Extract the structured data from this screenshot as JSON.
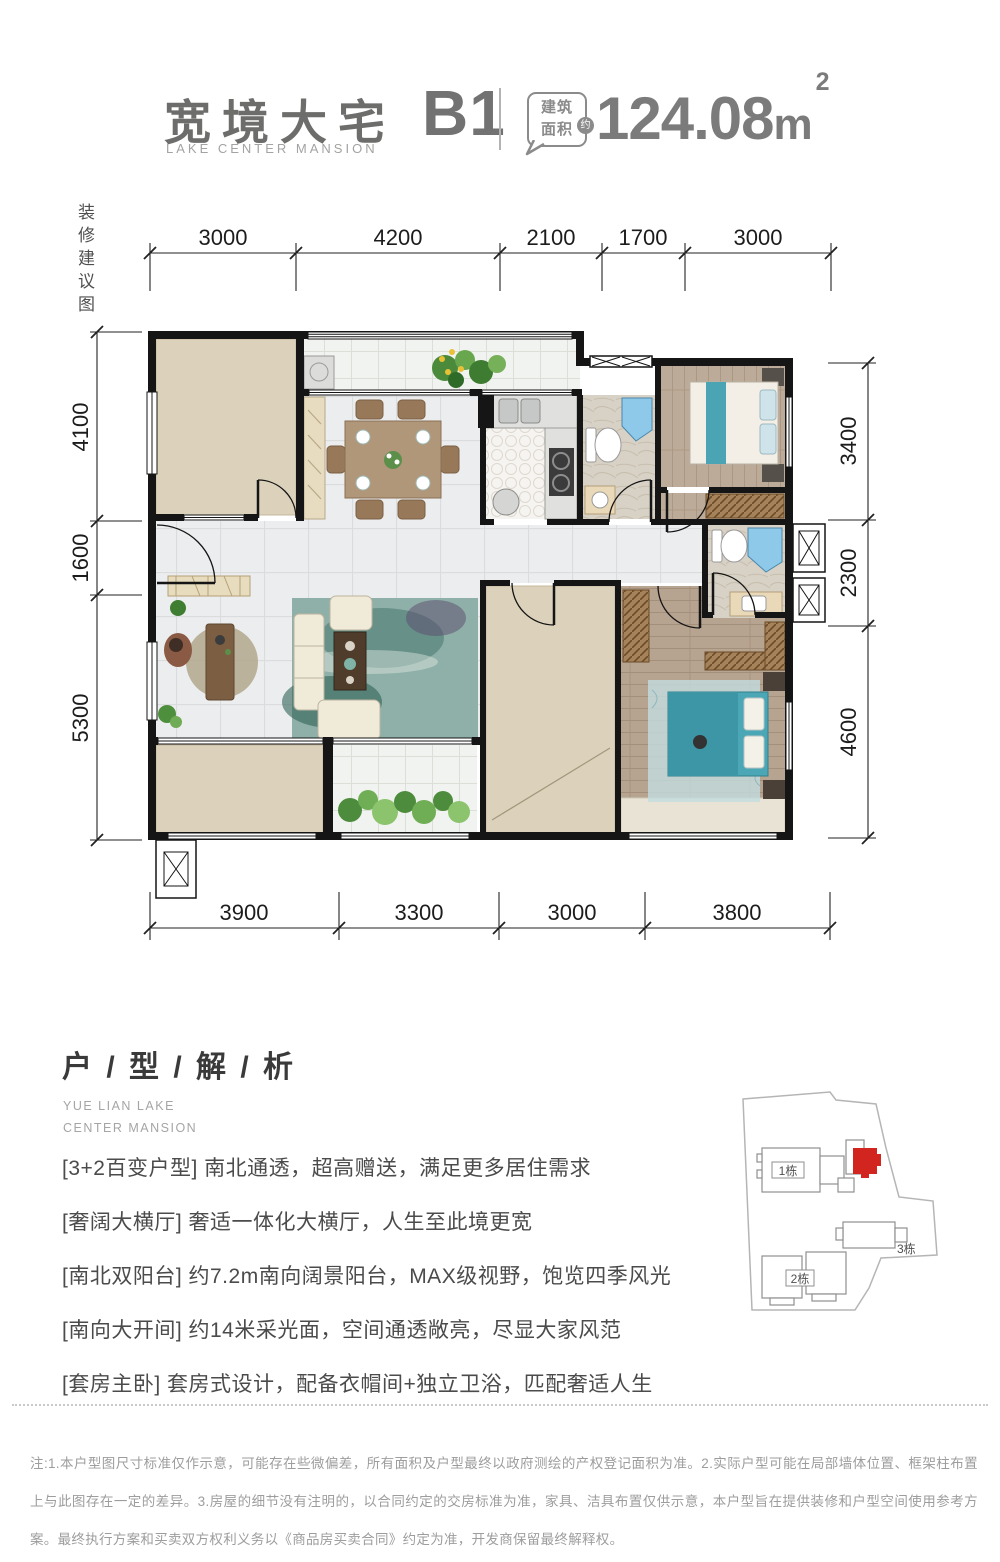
{
  "header": {
    "title": "宽境大宅",
    "subtitle": "LAKE CENTER MANSION",
    "unit": "B1",
    "area_tag_line1": "建筑",
    "area_tag_line2": "面积",
    "area_approx": "约",
    "area_value": "124.08",
    "area_unit": "m",
    "area_superscript": "2"
  },
  "side_note": "装修建议图",
  "plan": {
    "dims_top": [
      "3000",
      "4200",
      "2100",
      "1700",
      "3000"
    ],
    "dims_left": [
      "4100",
      "1600",
      "5300"
    ],
    "dims_right": [
      "3400",
      "2300",
      "4600"
    ],
    "dims_bottom": [
      "3900",
      "3300",
      "3000",
      "3800"
    ]
  },
  "analysis": {
    "heading": "户 / 型 / 解 / 析",
    "subheading_line1": "YUE LIAN LAKE",
    "subheading_line2": "CENTER MANSION",
    "points": [
      "[3+2百变户型] 南北通透，超高赠送，满足更多居住需求",
      "[奢阔大横厅] 奢适一体化大横厅，人生至此境更宽",
      "[南北双阳台] 约7.2m南向阔景阳台，MAX级视野，饱览四季风光",
      "[南向大开间] 约14米采光面，空间通透敞亮，尽显大家风范",
      "[套房主卧] 套房式设计，配备衣帽间+独立卫浴，匹配奢适人生"
    ]
  },
  "sitemap": {
    "building1_label": "1栋",
    "building2_label": "2栋",
    "building3_label": "3栋",
    "highlight_color": "#d2251f"
  },
  "footer": {
    "disclaimer": "注:1.本户型图尺寸标准仅作示意，可能存在些微偏差，所有面积及户型最终以政府测绘的产权登记面积为准。2.实际户型可能在局部墙体位置、框架柱布置上与此图存在一定的差异。3.房屋的细节没有注明的，以合同约定的交房标准为准，家具、洁具布置仅供示意，本户型旨在提供装修和户型空间使用参考方案。最终执行方案和买卖双方权利义务以《商品房买卖合同》约定为准，开发商保留最终解释权。"
  }
}
